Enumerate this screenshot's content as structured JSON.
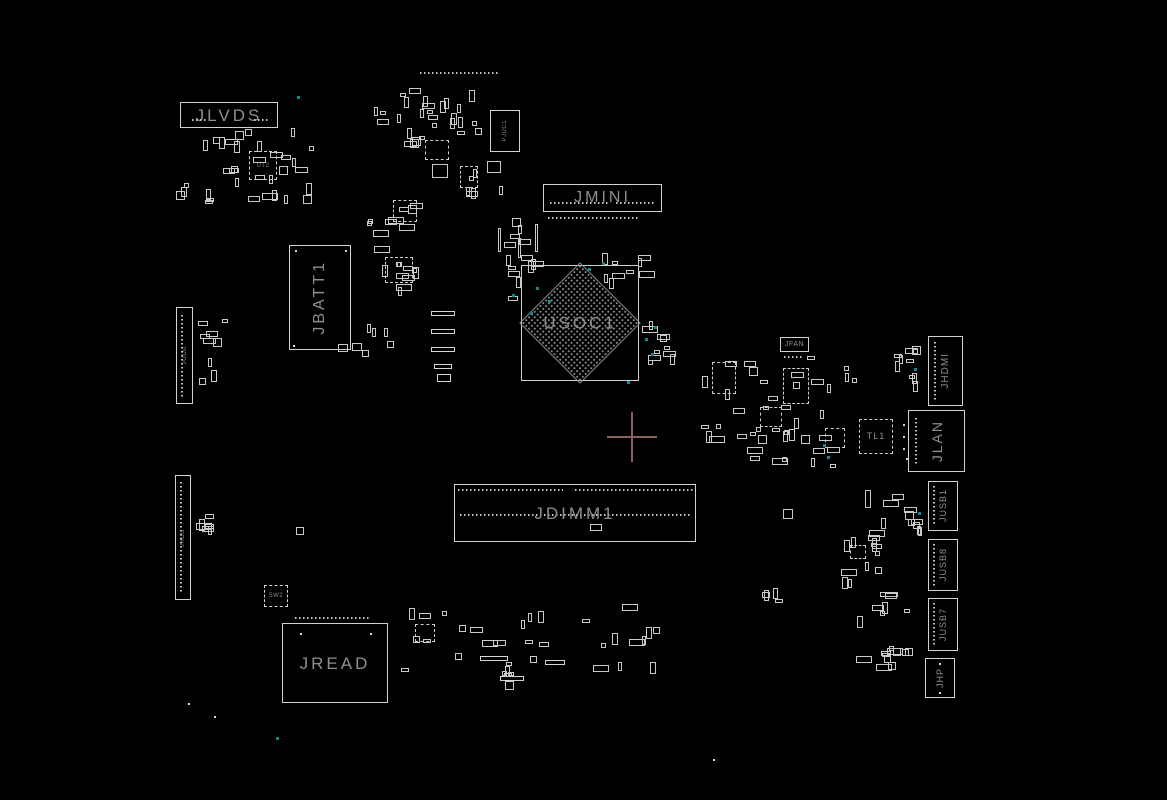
{
  "app": {
    "type": "pcb-boardview-silkscreen",
    "background": "#000000"
  },
  "labels": {
    "jlvds": "JLVDS",
    "jmini": "JMINI",
    "jbatt1": "JBATT1",
    "usoc1": "USOC1",
    "jdimm1": "JDIMM1",
    "jread": "JREAD",
    "jhdmi": "JHDMI",
    "jlan": "JLAN",
    "jusb1": "JUSB1",
    "jusb8": "JUSB8",
    "jusb7": "JUSB7",
    "jhp": "JHP",
    "tl1": "TL1",
    "jfan": "JFAN",
    "sw2": "SW2",
    "jodd": "JODD",
    "jhdd": "JHDD",
    "pjdc1": "PJDC1",
    "ut2": "UT2"
  },
  "colors": {
    "background": "#000000",
    "outline": "#d2d2d2",
    "label_text": "#8f8f8f",
    "pin_dots": "#c4c4c4",
    "crosshair": "#8a6060",
    "test_point_teal": "#0f8a8a"
  },
  "crosshair": {
    "x": 632,
    "y": 437,
    "arm": 25,
    "thickness": 2
  },
  "decor": {
    "seed": 7,
    "pin_rows": [
      [
        420,
        72,
        78,
        "h"
      ],
      [
        550,
        202,
        58,
        "h"
      ],
      [
        616,
        202,
        40,
        "h"
      ],
      [
        548,
        217,
        92,
        "h"
      ],
      [
        458,
        489,
        105,
        "h"
      ],
      [
        575,
        489,
        118,
        "h"
      ],
      [
        460,
        514,
        232,
        "h"
      ],
      [
        295,
        617,
        76,
        "h"
      ],
      [
        181,
        315,
        82,
        "v"
      ],
      [
        180,
        482,
        112,
        "v"
      ],
      [
        934,
        342,
        58,
        "v"
      ],
      [
        915,
        418,
        46,
        "v"
      ],
      [
        933,
        486,
        40,
        "v"
      ],
      [
        933,
        544,
        42,
        "v"
      ],
      [
        933,
        603,
        43,
        "v"
      ],
      [
        784,
        356,
        20,
        "h"
      ],
      [
        192,
        119,
        14,
        "h"
      ],
      [
        254,
        119,
        14,
        "h"
      ]
    ],
    "bars": [
      [
        431,
        311,
        24,
        5
      ],
      [
        431,
        329,
        24,
        5
      ],
      [
        431,
        347,
        24,
        5
      ],
      [
        434,
        364,
        18,
        5
      ],
      [
        480,
        656,
        28,
        5
      ],
      [
        500,
        676,
        24,
        5
      ],
      [
        545,
        660,
        20,
        5
      ],
      [
        437,
        374,
        14,
        8
      ]
    ],
    "ics": [
      [
        393,
        200,
        24,
        22
      ],
      [
        385,
        257,
        28,
        26
      ],
      [
        825,
        428,
        20,
        20
      ],
      [
        712,
        362,
        24,
        32
      ],
      [
        783,
        368,
        26,
        36
      ],
      [
        760,
        407,
        22,
        20
      ],
      [
        850,
        545,
        16,
        14
      ],
      [
        415,
        624,
        20,
        18
      ],
      [
        460,
        166,
        18,
        22
      ],
      [
        425,
        140,
        24,
        20
      ]
    ],
    "parts": [
      [
        432,
        164,
        16,
        14
      ],
      [
        487,
        161,
        14,
        12
      ],
      [
        590,
        524,
        12,
        7
      ],
      [
        352,
        343,
        10,
        8
      ],
      [
        362,
        350,
        7,
        7
      ],
      [
        296,
        527,
        8,
        8
      ],
      [
        783,
        509,
        10,
        10
      ],
      [
        865,
        490,
        6,
        18
      ],
      [
        872,
        538,
        5,
        14
      ],
      [
        880,
        592,
        18,
        5
      ],
      [
        893,
        648,
        8,
        8
      ],
      [
        905,
        648,
        8,
        8
      ],
      [
        888,
        662,
        8,
        8
      ],
      [
        762,
        592,
        8,
        6
      ],
      [
        535,
        224,
        3,
        28
      ],
      [
        498,
        228,
        3,
        24
      ],
      [
        518,
        238,
        3,
        20
      ],
      [
        338,
        344,
        10,
        8
      ],
      [
        205,
        514,
        9,
        5
      ],
      [
        205,
        524,
        9,
        5
      ],
      [
        181,
        187,
        6,
        10
      ]
    ],
    "clusters": [
      [
        198,
        128,
        118,
        78,
        30
      ],
      [
        176,
        183,
        40,
        22,
        3
      ],
      [
        363,
        86,
        75,
        62,
        12
      ],
      [
        398,
        88,
        78,
        48,
        10
      ],
      [
        452,
        158,
        52,
        42,
        6
      ],
      [
        363,
        190,
        62,
        48,
        9
      ],
      [
        368,
        240,
        58,
        62,
        11
      ],
      [
        440,
        96,
        45,
        40,
        6
      ],
      [
        505,
        247,
        42,
        55,
        9
      ],
      [
        600,
        252,
        58,
        46,
        9
      ],
      [
        633,
        318,
        48,
        58,
        10
      ],
      [
        493,
        216,
        40,
        38,
        5
      ],
      [
        700,
        356,
        158,
        112,
        42
      ],
      [
        893,
        328,
        30,
        68,
        10
      ],
      [
        878,
        478,
        46,
        62,
        10
      ],
      [
        838,
        528,
        62,
        72,
        13
      ],
      [
        852,
        598,
        70,
        82,
        13
      ],
      [
        398,
        604,
        122,
        86,
        17
      ],
      [
        520,
        600,
        142,
        90,
        17
      ],
      [
        196,
        318,
        38,
        80,
        9
      ],
      [
        193,
        505,
        26,
        30,
        4
      ],
      [
        757,
        585,
        30,
        20,
        3
      ],
      [
        365,
        320,
        30,
        30,
        4
      ]
    ],
    "teal_dots": [
      [
        297,
        96
      ],
      [
        536,
        287
      ],
      [
        548,
        300
      ],
      [
        530,
        312
      ],
      [
        588,
        268
      ],
      [
        602,
        262
      ],
      [
        645,
        338
      ],
      [
        651,
        353
      ],
      [
        627,
        381
      ],
      [
        823,
        444
      ],
      [
        827,
        456
      ],
      [
        914,
        368
      ],
      [
        918,
        512
      ],
      [
        276,
        737
      ],
      [
        654,
        326
      ],
      [
        512,
        294
      ]
    ],
    "white_dots": [
      [
        188,
        703
      ],
      [
        214,
        716
      ],
      [
        713,
        759
      ],
      [
        300,
        633
      ],
      [
        370,
        633
      ],
      [
        939,
        663
      ],
      [
        939,
        692
      ],
      [
        293,
        345
      ],
      [
        345,
        250
      ],
      [
        295,
        250
      ],
      [
        903,
        424
      ],
      [
        903,
        436
      ],
      [
        903,
        448
      ],
      [
        906,
        458
      ]
    ]
  }
}
